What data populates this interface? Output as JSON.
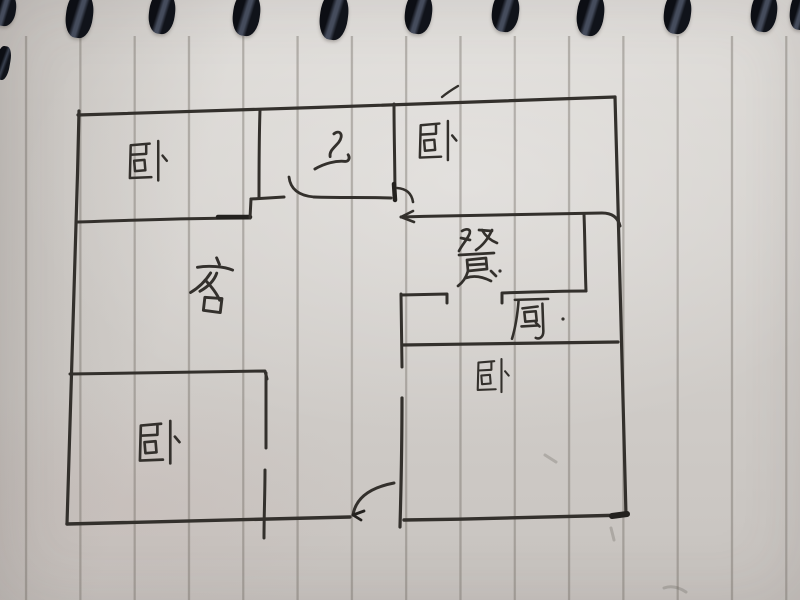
{
  "scene": {
    "description": "Hand-drawn apartment floor plan sketched in dark ink on a spiral-bound notebook page",
    "medium": "pen on lined paper",
    "orientation_note": "notebook rule lines run vertically; spiral binding along the top edge"
  },
  "rooms": [
    {
      "id": "bedroom-top-left",
      "label": "卧",
      "meaning": "bedroom"
    },
    {
      "id": "bathroom",
      "label": "卫",
      "meaning": "bathroom"
    },
    {
      "id": "bedroom-top-right",
      "label": "卧",
      "meaning": "bedroom"
    },
    {
      "id": "living-room",
      "label": "客",
      "meaning": "living room"
    },
    {
      "id": "dining-area",
      "label": "餐",
      "meaning": "dining"
    },
    {
      "id": "kitchen",
      "label": "厨",
      "meaning": "kitchen"
    },
    {
      "id": "bedroom-right",
      "label": "卧",
      "meaning": "bedroom"
    },
    {
      "id": "bedroom-bottom-left",
      "label": "卧",
      "meaning": "bedroom"
    }
  ],
  "features": {
    "binding_hole_count": 11,
    "doors": [
      "bathroom door with quarter-arc swing",
      "small door arc at top-right bedroom corner",
      "main entry door at bottom center with swing arc and arrow",
      "door gap in bottom-left bedroom wall",
      "door gap in right bedroom left wall"
    ]
  },
  "colors": {
    "paper": "#d9d6d2",
    "rule_line": "#8f8a82",
    "ink": "#33302c",
    "binding_wire": "#141820"
  }
}
